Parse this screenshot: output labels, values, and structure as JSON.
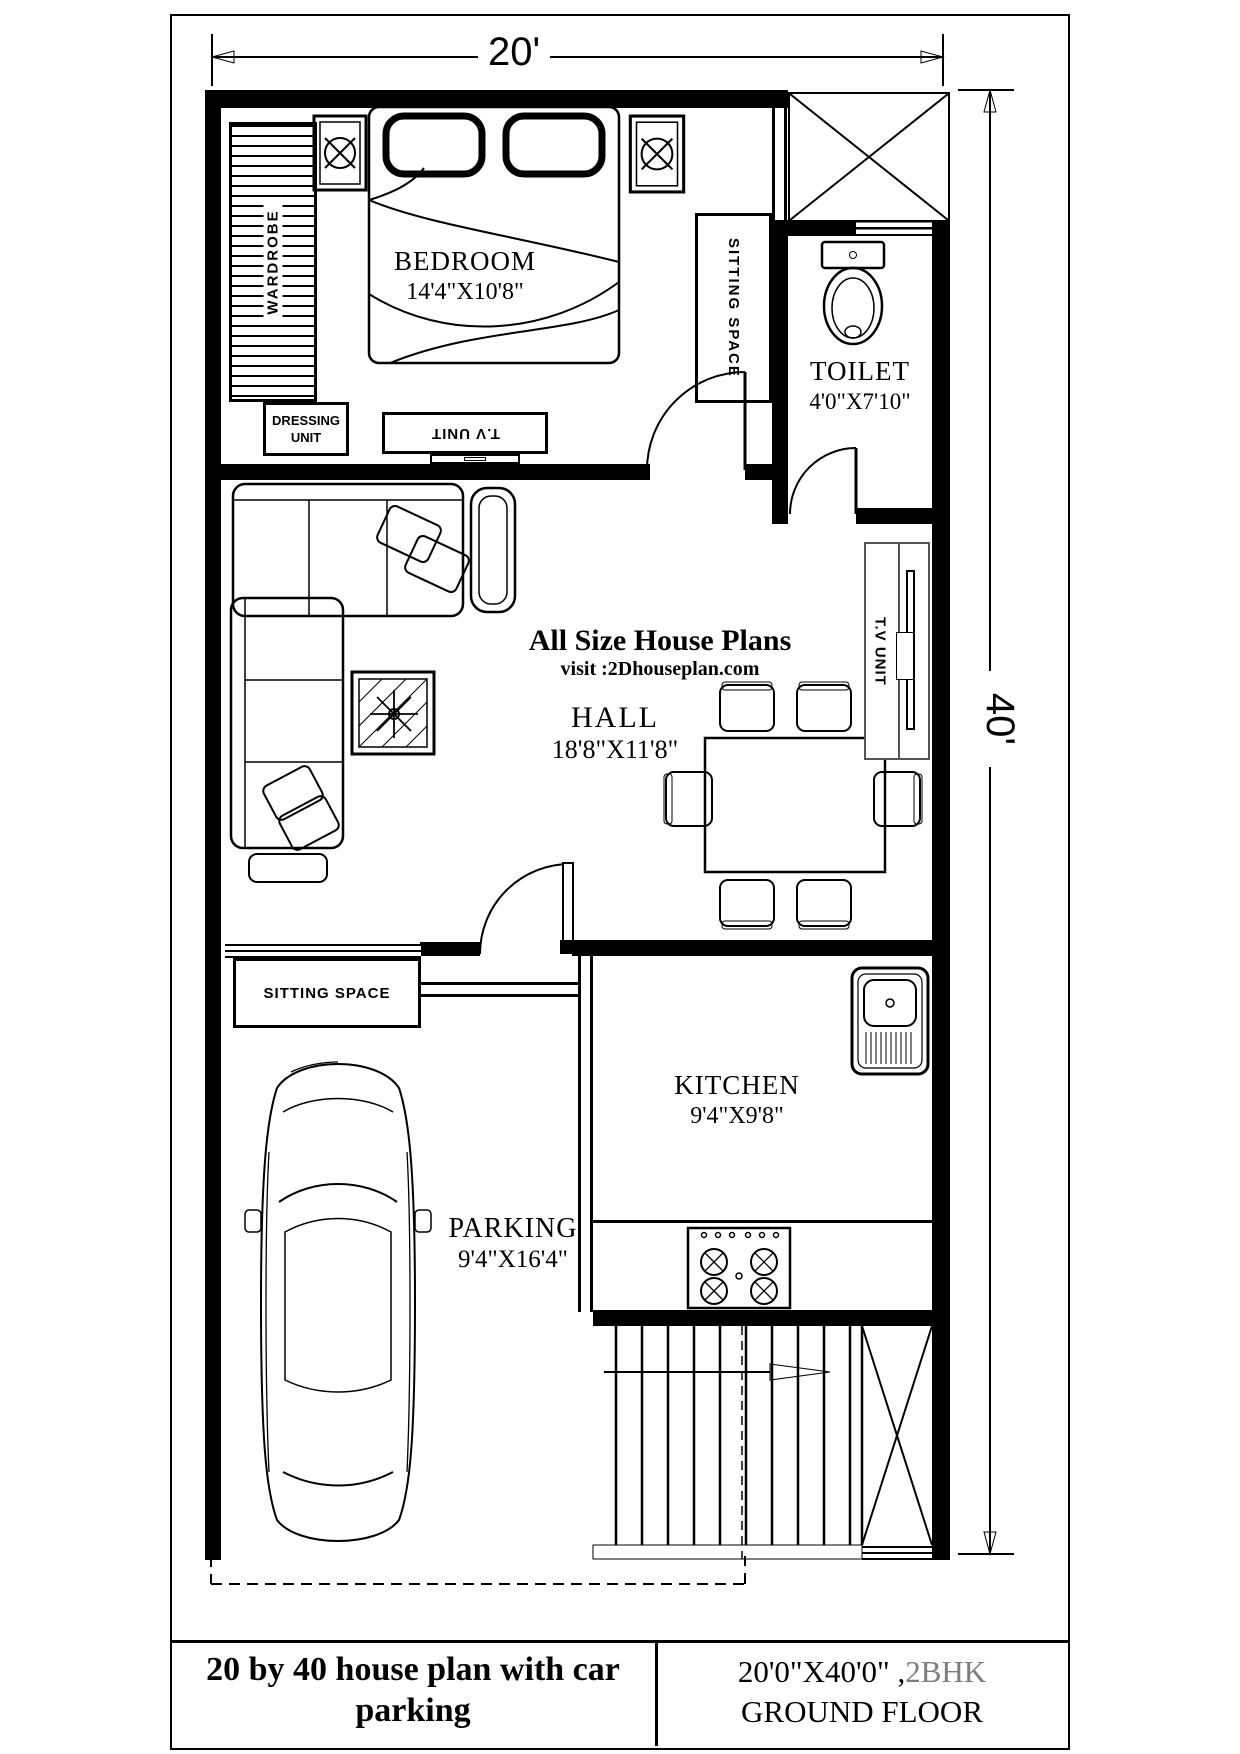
{
  "sheet": {
    "dim_width": "20'",
    "dim_height": "40'"
  },
  "watermark": {
    "line1": "All Size House Plans",
    "line2": "visit :2Dhouseplan.com"
  },
  "rooms": {
    "bedroom": {
      "name": "BEDROOM",
      "size": "14'4\"X10'8\""
    },
    "toilet": {
      "name": "TOILET",
      "size": "4'0\"X7'10\""
    },
    "hall": {
      "name": "HALL",
      "size": "18'8\"X11'8\""
    },
    "kitchen": {
      "name": "KITCHEN",
      "size": "9'4\"X9'8\""
    },
    "parking": {
      "name": "PARKING",
      "size": "9'4\"X16'4\""
    }
  },
  "labels": {
    "wardrobe": "WARDROBE",
    "sitting_space_top": "SITTING SPACE",
    "sitting_space_bottom": "SITTING SPACE",
    "dressing_unit": "DRESSING UNIT",
    "tv_unit_bedroom": "T.V UNIT",
    "tv_unit_hall": "T.V UNIT"
  },
  "title_block": {
    "left_title": "20 by 40 house plan with car parking",
    "right_size": "20'0\"X40'0\" ,",
    "right_bhk": "2BHK",
    "right_floor": "GROUND FLOOR"
  },
  "colors": {
    "ink": "#000000",
    "paper": "#ffffff",
    "bhk_gray": "#7d7d7d"
  }
}
